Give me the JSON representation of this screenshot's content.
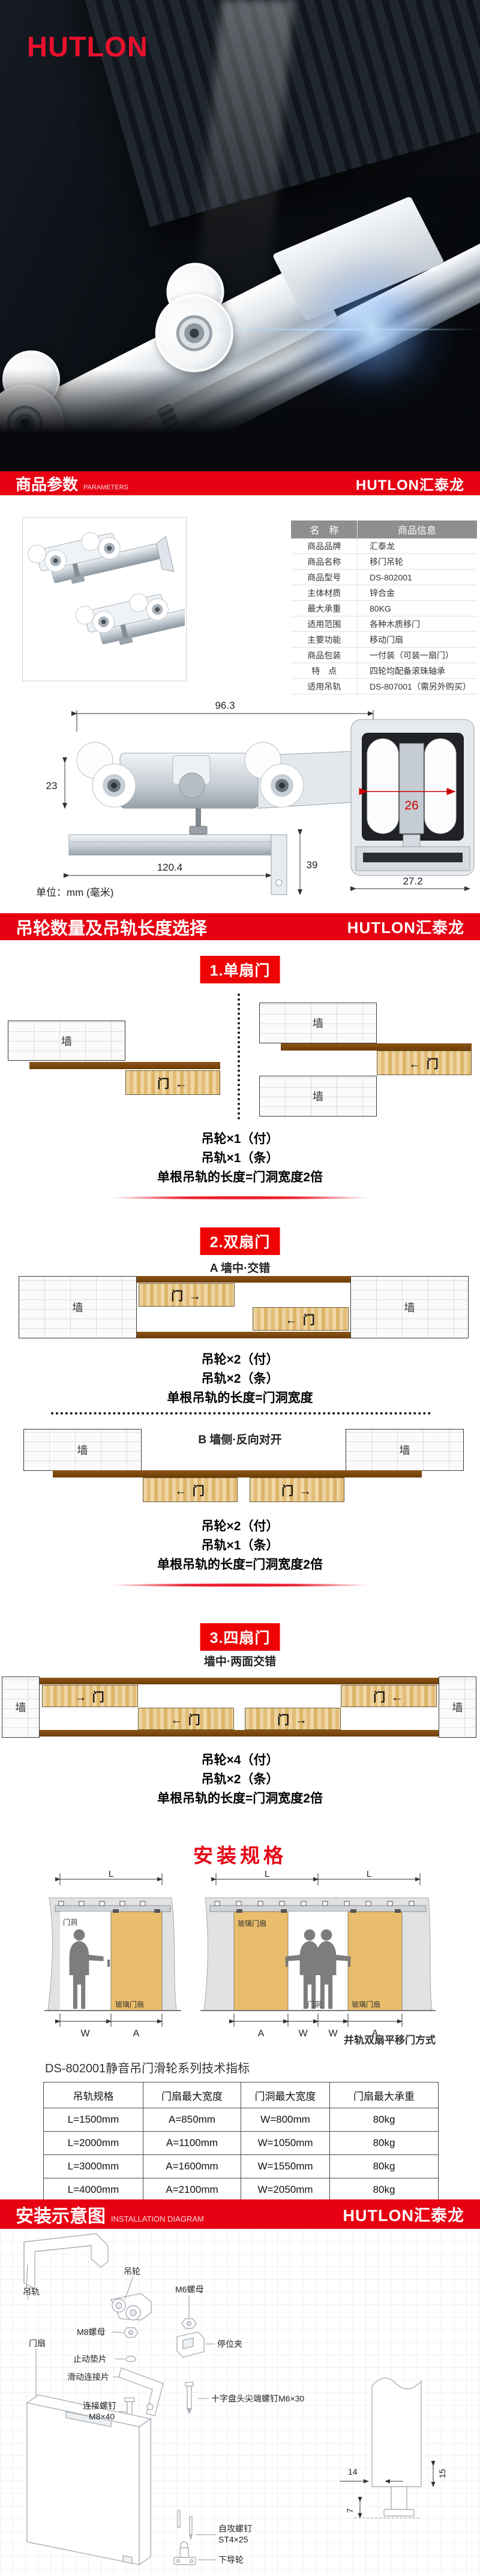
{
  "brand": {
    "logo": "HUTLON",
    "full": "HUTLON汇泰龙",
    "red": "#e60012"
  },
  "banner_params": {
    "title": "商品参数",
    "subtitle": "PARAMETERS"
  },
  "banner_selection": {
    "title": "吊轮数量及吊轨长度选择"
  },
  "banner_install": {
    "title": "安装示意图",
    "subtitle": "INSTALLATION DIAGRAM"
  },
  "spec_table": {
    "headers": [
      "名　称",
      "商品信息"
    ],
    "rows": [
      [
        "商品品牌",
        "汇泰龙"
      ],
      [
        "商品名称",
        "移门吊轮"
      ],
      [
        "商品型号",
        "DS-802001"
      ],
      [
        "主体材质",
        "锌合金"
      ],
      [
        "最大承重",
        "80KG"
      ],
      [
        "适用范围",
        "各种木质移门"
      ],
      [
        "主要功能",
        "移动门扇"
      ],
      [
        "商品包装",
        "一付装（可装一扇门）"
      ],
      [
        "特　点",
        "四轮均配备滚珠轴承"
      ],
      [
        "适用吊轨",
        "DS-807001（需另外购买）"
      ]
    ]
  },
  "drawing": {
    "dim_width": "96.3",
    "dim_left": "23",
    "dim_right": "17.8",
    "dim_rail": "120.4",
    "dim_bracket": "39",
    "dim_inner": "26",
    "dim_profile": "27.2",
    "unit": "单位：mm (毫米)"
  },
  "labels": {
    "wall": "墙"
  },
  "sections": {
    "single": {
      "badge": "1.单扇门",
      "doors": {
        "left": "门 ←",
        "right": "← 门"
      },
      "specs": [
        "吊轮×1（付）",
        "吊轨×1（条）",
        "单根吊轨的长度=门洞宽度2倍"
      ]
    },
    "double": {
      "badge": "2.双扇门",
      "a_label": "A 墙中·交错",
      "a_doors": [
        "门 →",
        "← 门"
      ],
      "a_specs": [
        "吊轮×2（付）",
        "吊轨×2（条）",
        "单根吊轨的长度=门洞宽度"
      ],
      "b_label": "B 墙侧·反向对开",
      "b_doors": [
        "← 门",
        "门 →"
      ],
      "b_specs": [
        "吊轮×2（付）",
        "吊轨×1（条）",
        "单根吊轨的长度=门洞宽度2倍"
      ]
    },
    "quad": {
      "badge": "3.四扇门",
      "sub": "墙中·两面交错",
      "doors": [
        "→ 门",
        "门 ←",
        "← 门",
        "门 →"
      ],
      "specs": [
        "吊轮×4（付）",
        "吊轨×2（条）",
        "单根吊轨的长度=门洞宽度2倍"
      ]
    }
  },
  "install": {
    "title": "安装规格",
    "dim_l": "L",
    "dim_w": "W",
    "dim_a": "A",
    "opening": "门洞",
    "glass_door": "玻璃门扇",
    "caption": "并轨双扇平移门方式",
    "table_title": "DS-802001静音吊门滑轮系列技术指标",
    "headers": [
      "吊轨规格",
      "门扇最大宽度",
      "门洞最大宽度",
      "门扇最大承重"
    ],
    "rows": [
      [
        "L=1500mm",
        "A=850mm",
        "W=800mm",
        "80kg"
      ],
      [
        "L=2000mm",
        "A=1100mm",
        "W=1050mm",
        "80kg"
      ],
      [
        "L=3000mm",
        "A=1600mm",
        "W=1550mm",
        "80kg"
      ],
      [
        "L=4000mm",
        "A=2100mm",
        "W=2050mm",
        "80kg"
      ]
    ]
  },
  "exploded": {
    "rail": "吊轨",
    "roller": "吊轮",
    "m6_nut": "M6螺母",
    "m8_nut": "M8螺母",
    "washer": "止动垫片",
    "slide_plate": "滑动连接片",
    "stop_clip": "停位夹",
    "screw_m6": "十字盘头尖端螺钉M6×30",
    "screw_m8_1": "连接螺钉",
    "screw_m8_2": "M8×40",
    "door_panel": "门扇",
    "self_screw_1": "自攻螺钉",
    "self_screw_2": "ST4×25",
    "bottom_guide": "下导轮",
    "dim_14": "14",
    "dim_15": "15",
    "dim_7": "7"
  }
}
